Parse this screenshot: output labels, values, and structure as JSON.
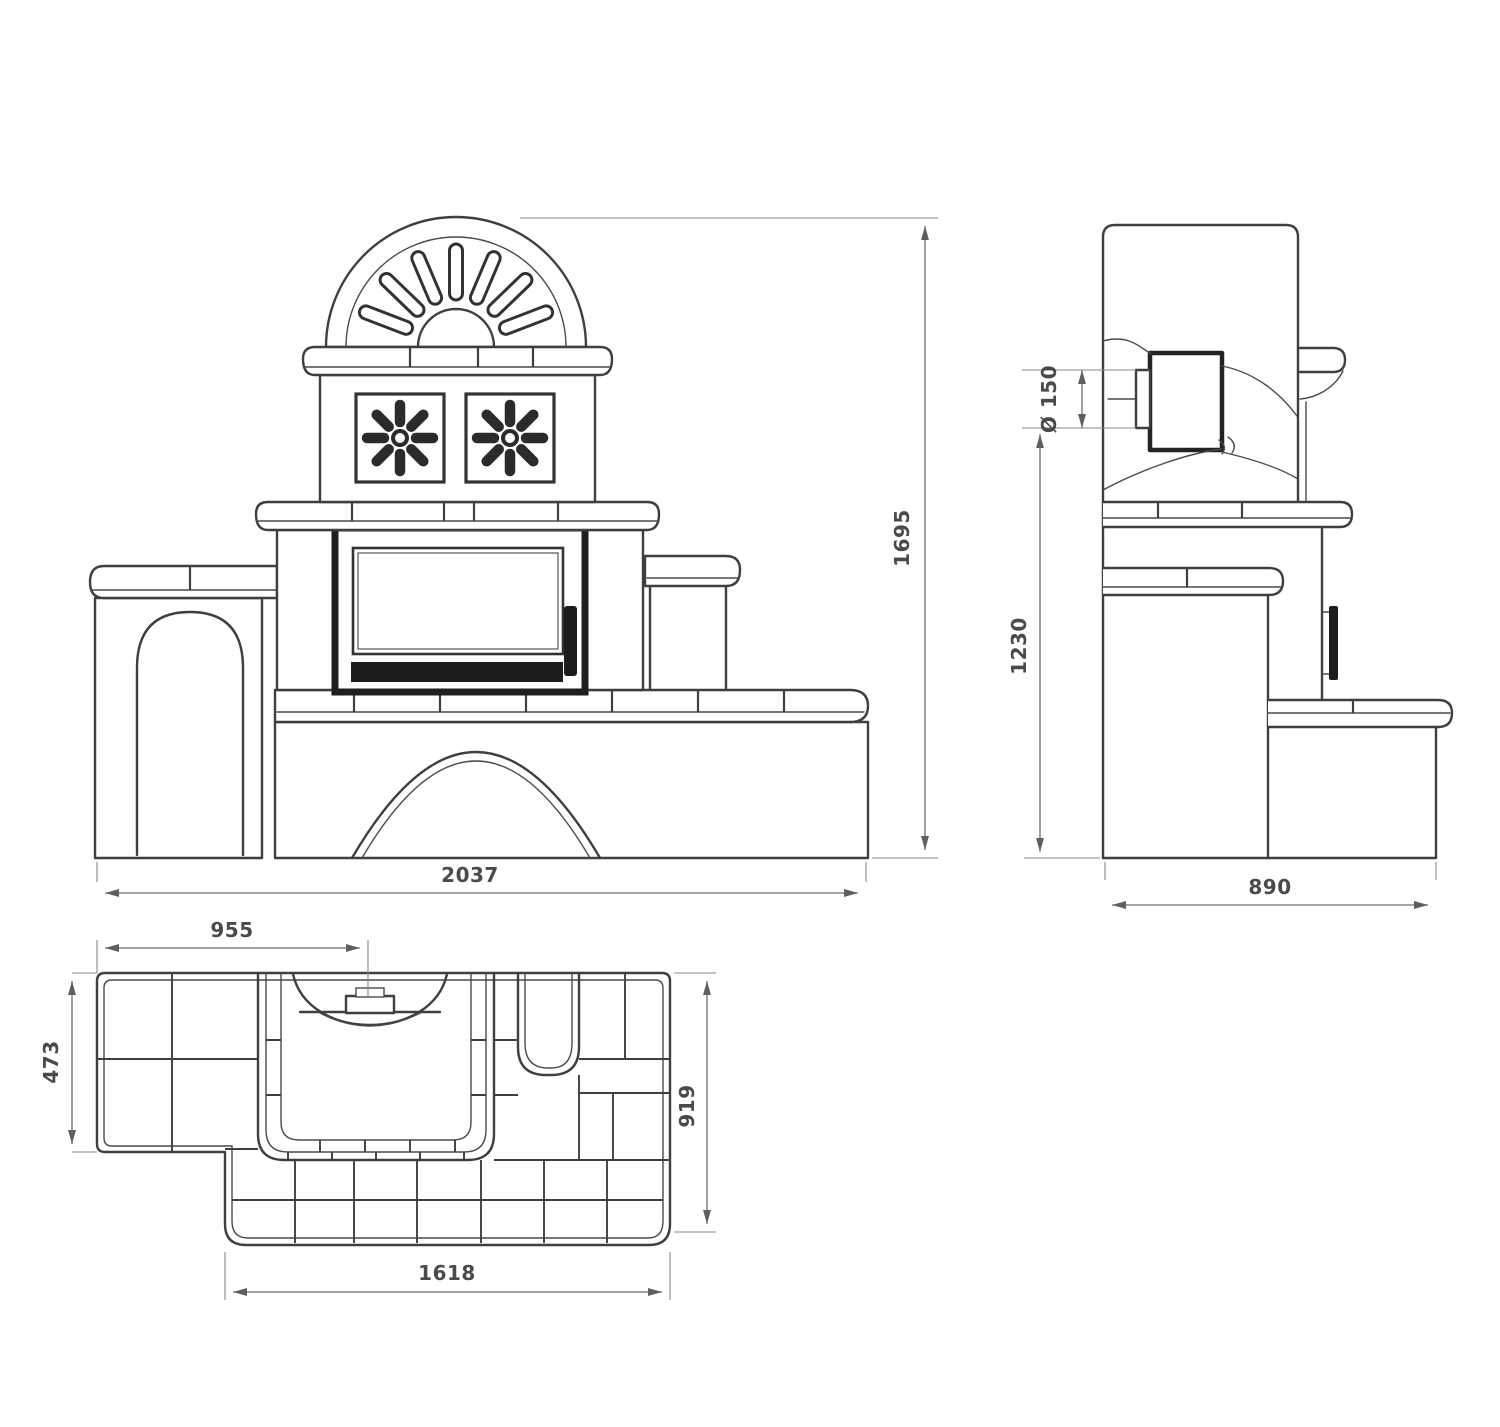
{
  "drawing": {
    "type": "technical-dimension-drawing",
    "subject": "tiled-stove-three-views",
    "colors": {
      "background": "#ffffff",
      "line": "#3f3f3f",
      "dimension": "#6e6e6e",
      "dark_fill": "#1d1d1d"
    }
  },
  "dimensions": {
    "front_width": "2037",
    "front_height": "1695",
    "side_height": "1230",
    "side_depth": "890",
    "flue_diameter": "Ø 150",
    "plan_firebox_axis": "955",
    "plan_left_bench_depth": "473",
    "plan_depth": "919",
    "plan_base_width": "1618"
  }
}
